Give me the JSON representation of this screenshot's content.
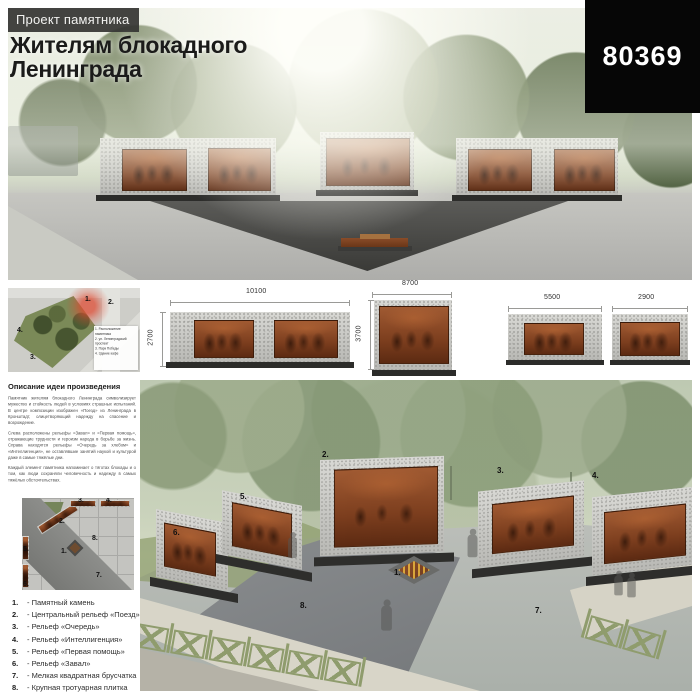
{
  "board": {
    "entry_id": "80369"
  },
  "header": {
    "kicker": "Проект памятника",
    "title_line1": "Жителям блокадного",
    "title_line2": "Ленинграда"
  },
  "elevations": {
    "left": {
      "width": "10100",
      "height": "2700"
    },
    "center": {
      "width": "8700",
      "height": "3700"
    },
    "right": {
      "width_a": "5500",
      "width_b": "2900"
    }
  },
  "site_plan": {
    "markers": [
      "1.",
      "2.",
      "3.",
      "4."
    ],
    "legend": [
      "1. Расположение памятника",
      "2. ул. Ленинградский проспект",
      "3. Парк Победы",
      "4. Здание кафе"
    ]
  },
  "description": {
    "heading": "Описание идеи произведения",
    "paragraphs": [
      "Памятник жителям блокадного Ленинграда символизирует мужество и стойкость людей в условиях страшных испытаний. В центре композиции изображен «Поезд» из Ленинграда в Кронштадт, олицетворяющий надежду на спасение и возрождение.",
      "Слева расположены рельефы «Завал» и «Первая помощь», отражающие трудности и героизм народа в борьбе за жизнь. Справа находятся рельефы «Очередь за хлебом» и «Интеллигенция», не оставлявшие занятий наукой и культурой даже в самые тяжёлые дни.",
      "Каждый элемент памятника напоминает о тяготах блокады и о том, как люди сохраняли человечность и надежду в самых тяжёлых обстоятельствах."
    ]
  },
  "callouts": [
    "1.",
    "2.",
    "3.",
    "4.",
    "5.",
    "6.",
    "7.",
    "8."
  ],
  "legend": {
    "items": [
      {
        "num": "1.",
        "text": "- Памятный камень"
      },
      {
        "num": "2.",
        "text": "- Центральный рельеф «Поезд»"
      },
      {
        "num": "3.",
        "text": "- Рельеф «Очередь»"
      },
      {
        "num": "4.",
        "text": "- Рельеф «Интеллигенция»"
      },
      {
        "num": "5.",
        "text": "- Рельеф «Первая помощь»"
      },
      {
        "num": "6.",
        "text": "- Рельеф «Завал»"
      },
      {
        "num": "7.",
        "text": "- Мелкая квадратная брусчатка"
      },
      {
        "num": "8.",
        "text": "- Крупная тротуарная плитка"
      }
    ]
  },
  "colors": {
    "copper_relief": "#8a4a28",
    "granite": "#c9c9c5",
    "base_dark": "#2c2c2a",
    "fence_green": "#8f9c6d",
    "park_green": "#7b8a58",
    "marker_red": "#d23c28",
    "id_box_bg": "#060606"
  }
}
